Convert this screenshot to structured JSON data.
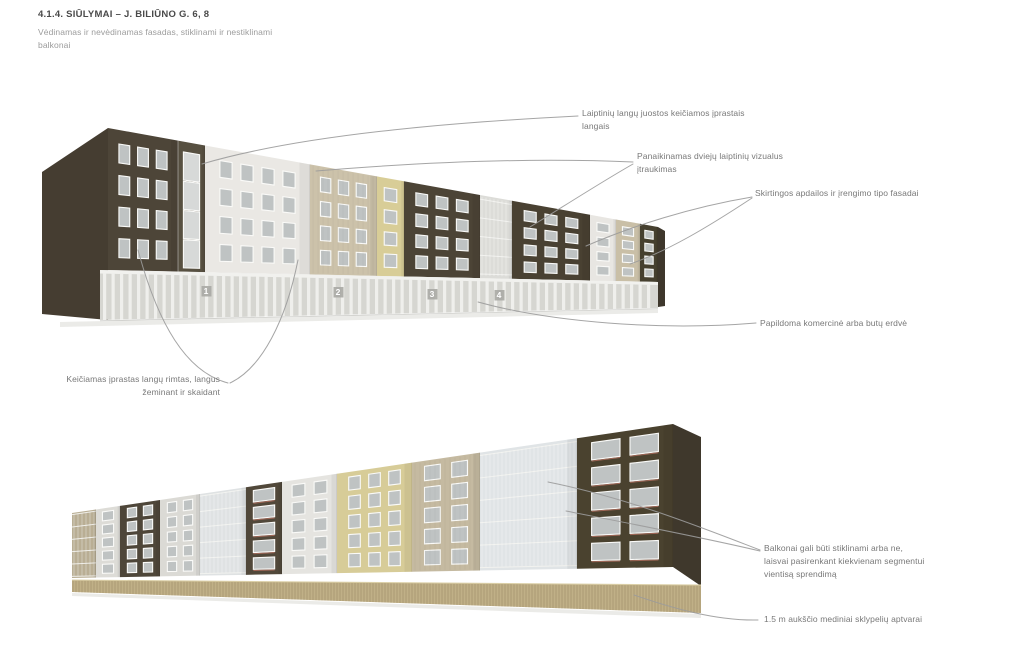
{
  "header": {
    "title": "4.1.4. SIŪLYMAI – J. BILIŪNO G. 6, 8",
    "subtitle_lines": [
      "Vėdinamas ir nevėdinamas fasadas, stiklinami ir nestiklinami",
      "balkonai"
    ]
  },
  "annotations": [
    {
      "id": "stairwell-window-bands",
      "lines": [
        "Laiptinių langų juostos keičiamos įprastais",
        "langais"
      ]
    },
    {
      "id": "stairwell-recess-removed",
      "lines": [
        "Panaikinamas dviejų laiptinių vizualus",
        "įtraukimas"
      ]
    },
    {
      "id": "different-facade-types",
      "lines": [
        "Skirtingos apdailos ir įrengimo tipo fasadai"
      ]
    },
    {
      "id": "extra-commercial-space",
      "lines": [
        "Papildoma komercinė arba butų erdvė"
      ]
    },
    {
      "id": "window-rhythm-changed",
      "lines": [
        "Keičiamas įprastas langų rimtas, langus",
        "žeminant ir skaidant"
      ]
    },
    {
      "id": "balconies-glazed-or-not",
      "lines": [
        "Balkonai gali būti stiklinami arba ne,",
        "laisvai pasirenkant kiekvienam segmentui",
        "vientisą sprendimą"
      ]
    },
    {
      "id": "wooden-fence",
      "lines": [
        "1.5 m aukščio mediniai sklypelių aptvarai"
      ]
    }
  ],
  "leader_lines": [
    "M 578 116 C 480 121 310 132 202 164",
    "M 633 164 C 598 184 558 210 530 227",
    "M 633 162 C 520 157 400 164 316 171",
    "M 752 197 C 692 207 632 226 586 246",
    "M 752 198 C 708 227 668 251 630 264",
    "M 756 323 C 660 331 550 322 478 302",
    "M 228 383 C 186 372 158 324 138 250",
    "M 230 383 C 262 368 286 320 298 260",
    "M 760 550 C 700 527 628 498 548 482",
    "M 760 551 C 696 536 622 522 566 511",
    "M 758 620 C 716 621 672 608 634 595"
  ],
  "colors": {
    "leader_line": "#9b9b9b",
    "window_frame": "#fafaf8",
    "window_glass": "#bfc3c3",
    "balcony_rail_red": "#a96b5b",
    "ground_shadow": "#ebebe8",
    "unit_label_text": "#ffffff",
    "unit_label_tile": "#a9a9a4"
  },
  "figures": {
    "top_building": {
      "x0": 108,
      "x1": 658,
      "top_y": [
        128,
        227
      ],
      "facade_bottom_y": [
        270,
        282
      ],
      "ground_y": [
        320,
        308
      ],
      "rows": 4,
      "row_start": 0.1,
      "row_step": 0.225,
      "win_h": 0.135,
      "col_pitch": 24,
      "end_wall": {
        "points": [
          [
            42,
            172
          ],
          [
            108,
            128
          ],
          [
            108,
            320
          ],
          [
            42,
            314
          ]
        ],
        "color": "#453d31"
      },
      "right_wall": {
        "points": [
          [
            658,
            227
          ],
          [
            665,
            231
          ],
          [
            665,
            306
          ],
          [
            658,
            307
          ]
        ],
        "color": "#3e372c"
      },
      "segments": [
        {
          "x0": 108,
          "x1": 178,
          "color": "#4d4538",
          "type": "punched"
        },
        {
          "x0": 178,
          "x1": 205,
          "color": "#575041",
          "type": "stair"
        },
        {
          "x0": 205,
          "x1": 310,
          "color": "#eae8e4",
          "type": "punched"
        },
        {
          "x0": 310,
          "x1": 377,
          "color": "#ccc2aa",
          "type": "punched",
          "siding": true
        },
        {
          "x0": 377,
          "x1": 404,
          "color": "#d8cd97",
          "type": "punched"
        },
        {
          "x0": 404,
          "x1": 480,
          "color": "#4c4436",
          "type": "punched"
        },
        {
          "x0": 480,
          "x1": 512,
          "color": "#dcdcd8",
          "type": "glazed"
        },
        {
          "x0": 512,
          "x1": 590,
          "color": "#494132",
          "type": "punched"
        },
        {
          "x0": 590,
          "x1": 616,
          "color": "#e8e6e2",
          "type": "punched"
        },
        {
          "x0": 616,
          "x1": 640,
          "color": "#c9bfa7",
          "type": "punched"
        },
        {
          "x0": 640,
          "x1": 658,
          "color": "#46402f",
          "type": "punched"
        }
      ],
      "colonnade": {
        "x0": 100,
        "x1": 658,
        "interior": "#d6d6d1",
        "fascia": "#f1f1ee",
        "column": "#efefec",
        "base_line": "#bdbdb9"
      },
      "unit_labels": [
        {
          "n": "1",
          "x": 206,
          "y": 294
        },
        {
          "n": "2",
          "x": 338,
          "y": 295
        },
        {
          "n": "3",
          "x": 432,
          "y": 297
        },
        {
          "n": "4",
          "x": 499,
          "y": 298
        }
      ]
    },
    "bottom_building": {
      "x0": 72,
      "x1": 673,
      "top_y": [
        513,
        424
      ],
      "facade_bottom_y": [
        578,
        567
      ],
      "rows": 5,
      "row_start": 0.05,
      "row_step": 0.19,
      "win_h": 0.13,
      "col_k": 3.5,
      "right_wall": {
        "points": [
          [
            673,
            424
          ],
          [
            701,
            437
          ],
          [
            701,
            586
          ],
          [
            673,
            567
          ]
        ],
        "color": "#3f382c"
      },
      "segments": [
        {
          "x0": 72,
          "x1": 96,
          "color": "#b9ae94",
          "type": "glazed"
        },
        {
          "x0": 96,
          "x1": 120,
          "color": "#dddcd7",
          "type": "punched"
        },
        {
          "x0": 120,
          "x1": 160,
          "color": "#4e4639",
          "type": "punched"
        },
        {
          "x0": 160,
          "x1": 200,
          "color": "#dbdad5",
          "type": "punched"
        },
        {
          "x0": 200,
          "x1": 246,
          "color": "#dfe2e3",
          "type": "glazed"
        },
        {
          "x0": 246,
          "x1": 282,
          "color": "#51483a",
          "type": "balcony-red"
        },
        {
          "x0": 282,
          "x1": 337,
          "color": "#e5e4e0",
          "type": "punched"
        },
        {
          "x0": 337,
          "x1": 412,
          "color": "#d7cc98",
          "type": "punched"
        },
        {
          "x0": 412,
          "x1": 480,
          "color": "#c5baa1",
          "type": "punched",
          "siding": true
        },
        {
          "x0": 480,
          "x1": 577,
          "color": "#e0e4e6",
          "type": "glazed"
        },
        {
          "x0": 577,
          "x1": 673,
          "color": "#4a422f",
          "type": "balcony-red"
        }
      ],
      "fence": {
        "x0": 72,
        "x1": 701,
        "top_y": [
          580,
          585
        ],
        "bottom_y": [
          592,
          613
        ],
        "color": "#c0b087",
        "slat_color": "#a3926d",
        "rail_color": "#dcd0a8",
        "pitch": 3
      }
    }
  }
}
